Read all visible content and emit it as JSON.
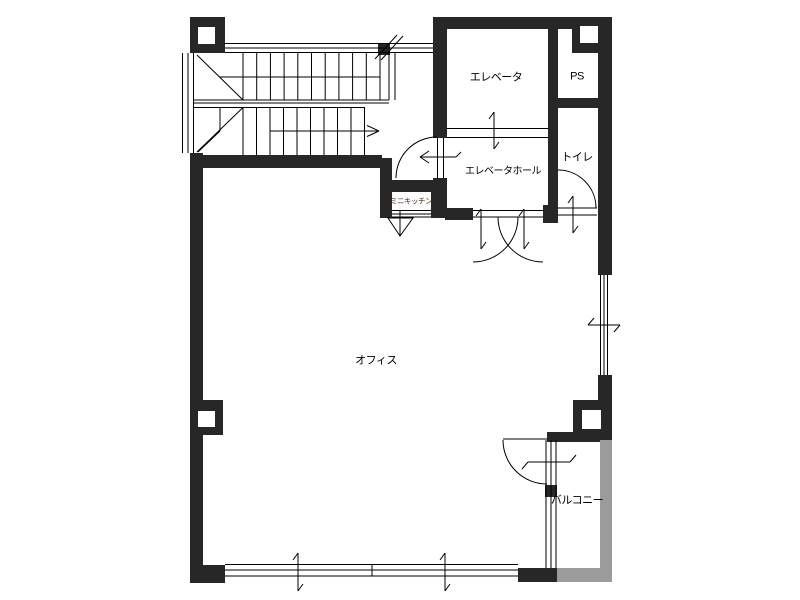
{
  "plan": {
    "type": "architectural-floor-plan",
    "rooms": {
      "elevator": {
        "label": "エレベータ"
      },
      "ps": {
        "label": "PS"
      },
      "elevator_hall": {
        "label": "エレベータホール"
      },
      "toilet": {
        "label": "トイレ"
      },
      "mini_kitchen": {
        "label": "ミニキッチン"
      },
      "office": {
        "label": "オフィス"
      },
      "balcony": {
        "label": "バルコニー"
      }
    },
    "colors": {
      "wall": "#272727",
      "balcony_wall": "#9b9b9b",
      "line": "#000000",
      "background": "#ffffff",
      "kitchen_label": "#4a3020"
    }
  }
}
